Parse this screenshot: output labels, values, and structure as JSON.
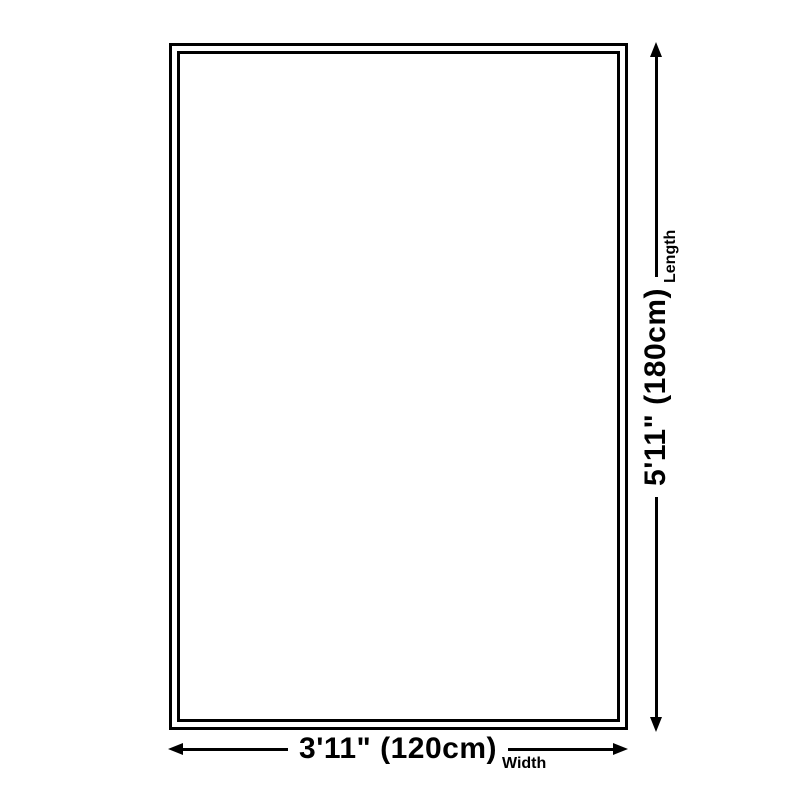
{
  "diagram": {
    "title": "rug-size-diagram",
    "width": {
      "value": "3'11\" (120cm)",
      "axis": "Width"
    },
    "length": {
      "value": "5'11\" (180cm)",
      "axis": "Length"
    },
    "colors": {
      "line": "#000000",
      "background": "#ffffff"
    }
  }
}
